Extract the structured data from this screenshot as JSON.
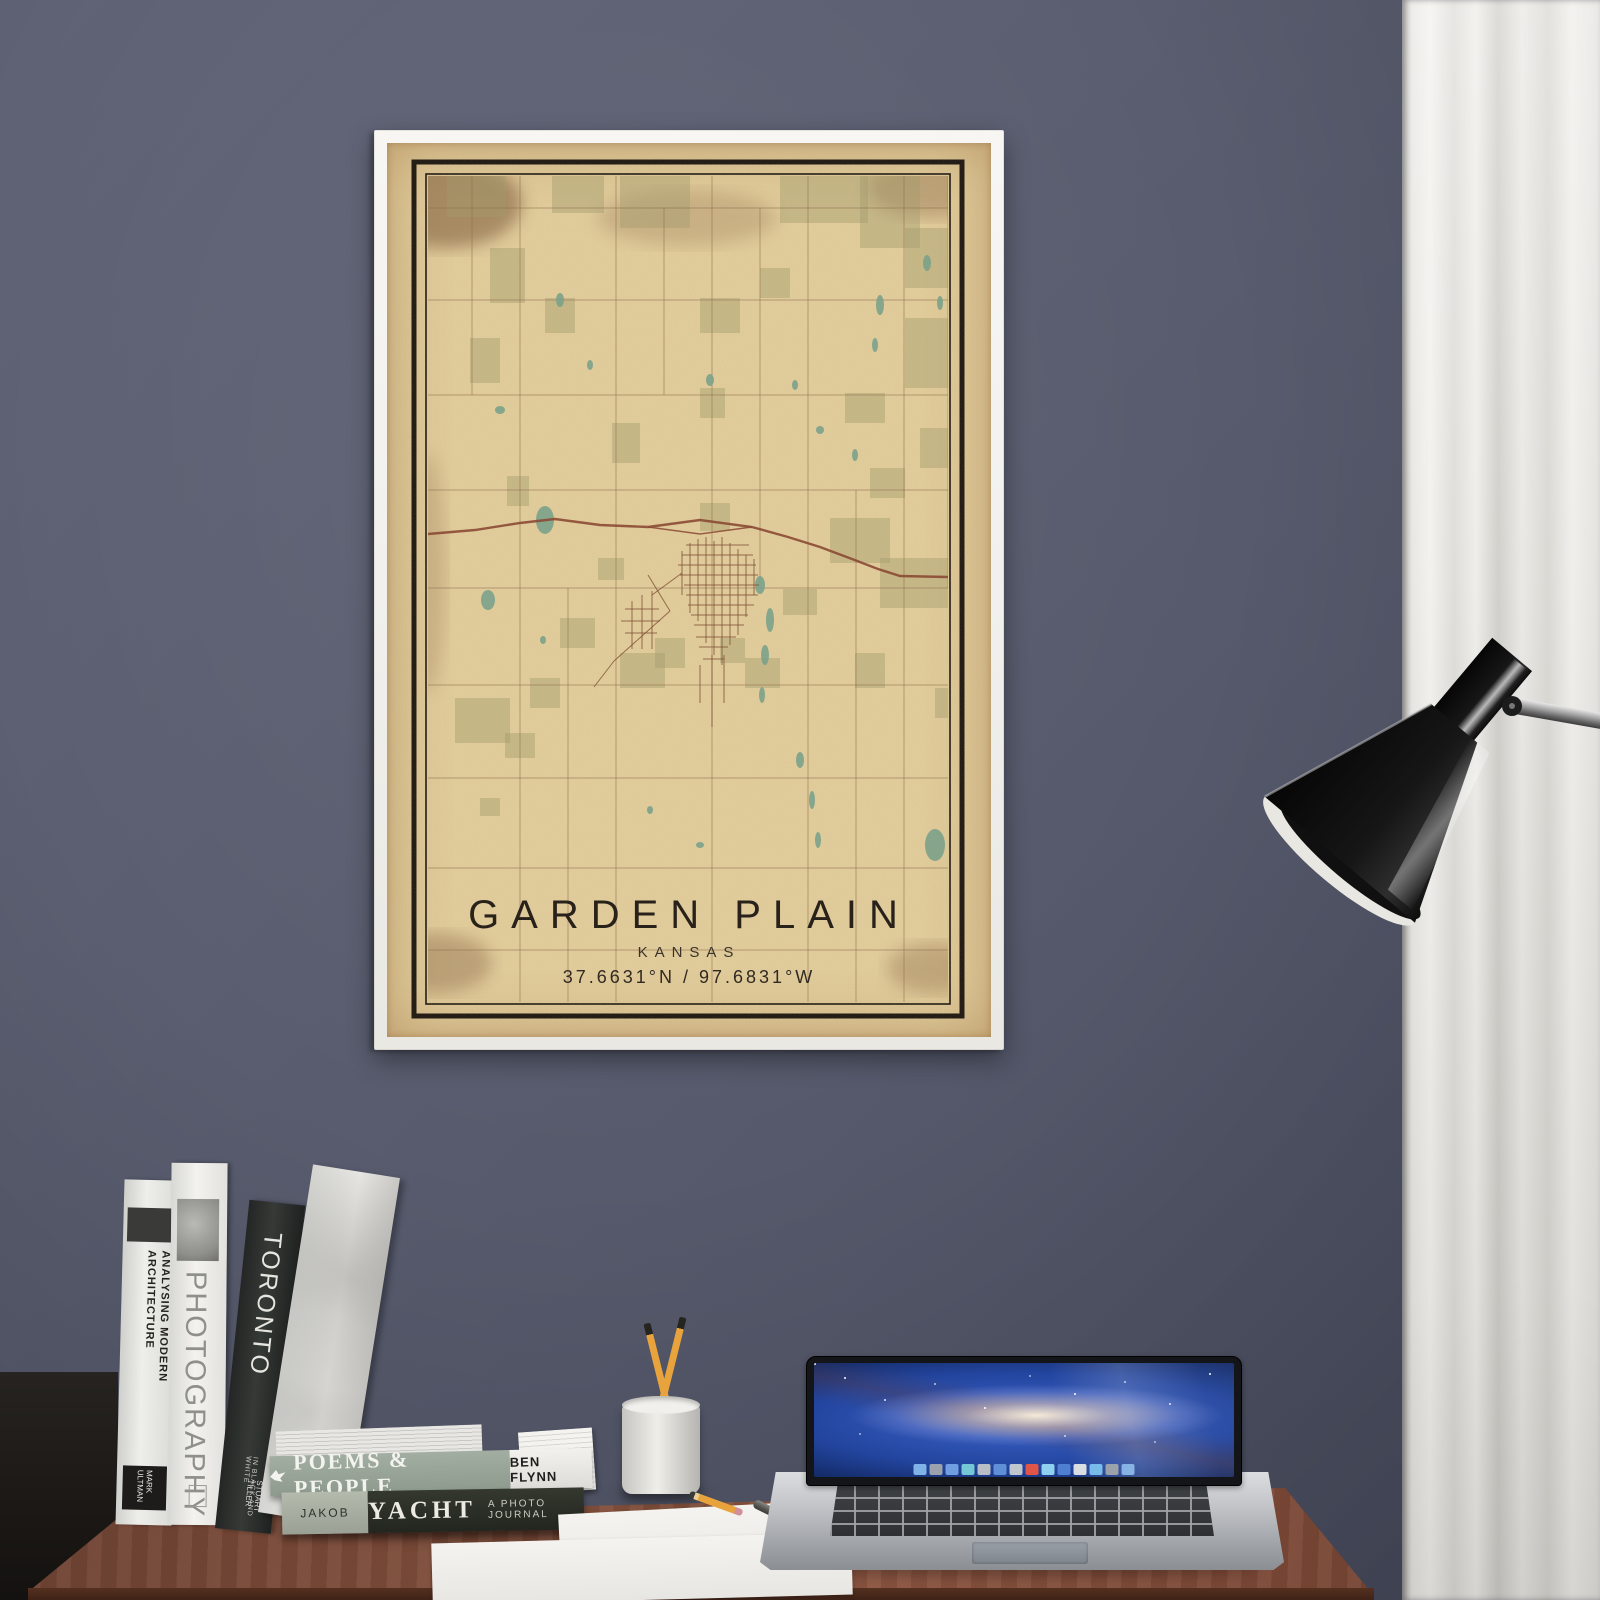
{
  "scene": {
    "wall_color": "#585c6e",
    "curtain_color": "#e9e8e4",
    "desk_color": "#7c4a37",
    "frame_color": "#f4f3ef"
  },
  "poster": {
    "title": "GARDEN PLAIN",
    "subtitle": "KANSAS",
    "coordinates": "37.6631°N / 97.6831°W",
    "colors": {
      "paper": "#e4cf9e",
      "border_ink": "#17120d",
      "grid": "#8a6a48",
      "street": "#7a4a30",
      "highway": "#86422e",
      "patch": "#9f9a6c",
      "lake": "#76a28c",
      "title_ink": "#28221b",
      "stain": "#6b4526"
    },
    "map": {
      "clip": [
        41,
        33,
        520,
        826
      ],
      "border_thick": [
        27,
        19,
        548,
        854
      ],
      "border_thin": [
        39,
        31,
        524,
        830
      ],
      "grid_v": [
        [
          37,
          33,
          859
        ],
        [
          85,
          33,
          252
        ],
        [
          133,
          33,
          859
        ],
        [
          181,
          445,
          859
        ],
        [
          229,
          33,
          859
        ],
        [
          277,
          65,
          252
        ],
        [
          325,
          33,
          859
        ],
        [
          373,
          65,
          445
        ],
        [
          421,
          33,
          859
        ],
        [
          469,
          347,
          859
        ],
        [
          517,
          33,
          859
        ],
        [
          561,
          33,
          445
        ]
      ],
      "grid_h": [
        [
          65,
          37,
          561
        ],
        [
          157,
          37,
          561
        ],
        [
          252,
          37,
          561
        ],
        [
          347,
          37,
          561
        ],
        [
          445,
          37,
          561
        ],
        [
          542,
          37,
          561
        ],
        [
          635,
          37,
          561
        ],
        [
          725,
          37,
          561
        ],
        [
          807,
          37,
          561
        ]
      ],
      "highway_main": [
        [
          41,
          391
        ],
        [
          88,
          387
        ],
        [
          133,
          380
        ],
        [
          168,
          376
        ],
        [
          213,
          382
        ],
        [
          261,
          384
        ],
        [
          313,
          377
        ],
        [
          365,
          384
        ],
        [
          401,
          394
        ],
        [
          433,
          404
        ],
        [
          465,
          416
        ],
        [
          491,
          426
        ],
        [
          513,
          433
        ],
        [
          561,
          434
        ]
      ],
      "highway_branch": [
        [
          261,
          384
        ],
        [
          313,
          391
        ],
        [
          365,
          384
        ]
      ],
      "streets": [
        [
          303,
          400,
          303,
          470
        ],
        [
          311,
          396,
          311,
          478
        ],
        [
          319,
          394,
          319,
          500
        ],
        [
          327,
          398,
          327,
          512
        ],
        [
          335,
          394,
          335,
          522
        ],
        [
          343,
          400,
          343,
          502
        ],
        [
          351,
          406,
          351,
          492
        ],
        [
          359,
          412,
          359,
          474
        ],
        [
          295,
          408,
          295,
          452
        ],
        [
          367,
          416,
          367,
          452
        ],
        [
          325,
          512,
          325,
          584
        ],
        [
          337,
          512,
          337,
          560
        ],
        [
          313,
          522,
          313,
          560
        ],
        [
          299,
          402,
          362,
          402
        ],
        [
          295,
          412,
          366,
          412
        ],
        [
          291,
          422,
          369,
          422
        ],
        [
          293,
          432,
          371,
          432
        ],
        [
          297,
          442,
          372,
          442
        ],
        [
          299,
          452,
          371,
          452
        ],
        [
          301,
          462,
          367,
          462
        ],
        [
          304,
          472,
          361,
          472
        ],
        [
          307,
          482,
          357,
          482
        ],
        [
          309,
          494,
          349,
          494
        ],
        [
          312,
          504,
          341,
          504
        ],
        [
          316,
          516,
          337,
          516
        ],
        [
          245,
          458,
          245,
          506
        ],
        [
          255,
          452,
          255,
          506
        ],
        [
          265,
          448,
          265,
          506
        ],
        [
          238,
          466,
          272,
          466
        ],
        [
          234,
          478,
          273,
          478
        ],
        [
          238,
          490,
          270,
          490
        ],
        [
          283,
          468,
          227,
          518
        ],
        [
          227,
          518,
          207,
          544
        ],
        [
          295,
          430,
          265,
          452
        ],
        [
          261,
          432,
          283,
          468
        ]
      ],
      "patches": [
        [
          60,
          28,
          58,
          46
        ],
        [
          165,
          30,
          52,
          40
        ],
        [
          233,
          30,
          70,
          55
        ],
        [
          393,
          30,
          88,
          50
        ],
        [
          473,
          30,
          60,
          75
        ],
        [
          518,
          85,
          45,
          60
        ],
        [
          103,
          105,
          35,
          55
        ],
        [
          83,
          195,
          30,
          45
        ],
        [
          158,
          155,
          30,
          35
        ],
        [
          313,
          155,
          40,
          35
        ],
        [
          373,
          125,
          30,
          30
        ],
        [
          518,
          175,
          45,
          70
        ],
        [
          458,
          250,
          40,
          30
        ],
        [
          313,
          245,
          25,
          30
        ],
        [
          225,
          280,
          28,
          40
        ],
        [
          533,
          285,
          30,
          40
        ],
        [
          483,
          325,
          35,
          30
        ],
        [
          313,
          360,
          30,
          28
        ],
        [
          443,
          375,
          60,
          45
        ],
        [
          493,
          415,
          70,
          50
        ],
        [
          173,
          475,
          35,
          30
        ],
        [
          233,
          510,
          45,
          35
        ],
        [
          268,
          495,
          30,
          30
        ],
        [
          143,
          535,
          30,
          30
        ],
        [
          68,
          555,
          55,
          45
        ],
        [
          118,
          590,
          30,
          25
        ],
        [
          358,
          515,
          35,
          30
        ],
        [
          333,
          495,
          25,
          25
        ],
        [
          468,
          510,
          30,
          35
        ],
        [
          548,
          545,
          20,
          30
        ],
        [
          93,
          655,
          20,
          18
        ],
        [
          211,
          415,
          26,
          22
        ],
        [
          396,
          446,
          34,
          26
        ],
        [
          120,
          333,
          22,
          30
        ]
      ],
      "lakes": [
        [
          158,
          377,
          9,
          14
        ],
        [
          173,
          157,
          4,
          7
        ],
        [
          113,
          267,
          5,
          4
        ],
        [
          203,
          222,
          3,
          5
        ],
        [
          323,
          237,
          4,
          6
        ],
        [
          408,
          242,
          3,
          5
        ],
        [
          433,
          287,
          4,
          4
        ],
        [
          468,
          312,
          3,
          6
        ],
        [
          373,
          442,
          5,
          9
        ],
        [
          383,
          477,
          4,
          12
        ],
        [
          378,
          512,
          4,
          10
        ],
        [
          375,
          552,
          3,
          8
        ],
        [
          413,
          617,
          4,
          8
        ],
        [
          425,
          657,
          3,
          9
        ],
        [
          431,
          697,
          3,
          8
        ],
        [
          548,
          702,
          10,
          16
        ],
        [
          313,
          702,
          4,
          3
        ],
        [
          263,
          667,
          3,
          4
        ],
        [
          156,
          497,
          3,
          4
        ],
        [
          493,
          162,
          4,
          10
        ],
        [
          488,
          202,
          3,
          7
        ],
        [
          101,
          457,
          7,
          10
        ],
        [
          540,
          120,
          4,
          8
        ],
        [
          553,
          160,
          3,
          7
        ]
      ],
      "stains": [
        [
          60,
          60,
          75,
          45,
          0.5
        ],
        [
          540,
          45,
          60,
          30,
          0.3
        ],
        [
          50,
          820,
          55,
          30,
          0.32
        ],
        [
          545,
          825,
          45,
          25,
          0.28
        ],
        [
          300,
          75,
          90,
          28,
          0.2
        ],
        [
          41,
          430,
          18,
          120,
          0.18
        ]
      ]
    }
  },
  "books": {
    "vertical": [
      {
        "title": "ANALYSING MODERN ARCHITECTURE",
        "author": "MARK ULTMAN"
      },
      {
        "title": "PHOTOGRAPHY"
      },
      {
        "title": "TORONTO",
        "subtitle": "IN BLACK AND WHITE",
        "author": "STUART TILLER"
      }
    ],
    "horizontal": [
      {
        "title": "POEMS & PEOPLE",
        "author": "BEN FLYNN"
      },
      {
        "title": "YACHT",
        "subtitle": "A PHOTO JOURNAL",
        "left_label": "JAKOB"
      }
    ]
  },
  "laptop": {
    "wallpaper": "galaxy",
    "dock_colors": [
      "#7fb3e8",
      "#9aa2ad",
      "#6f9fe0",
      "#74c7d4",
      "#b8bec6",
      "#5f8fd6",
      "#c0c6cd",
      "#e05548",
      "#8fd0f0",
      "#4f7fd0",
      "#d8dde2",
      "#6fb7e8",
      "#9098a2",
      "#74a8e0"
    ]
  }
}
